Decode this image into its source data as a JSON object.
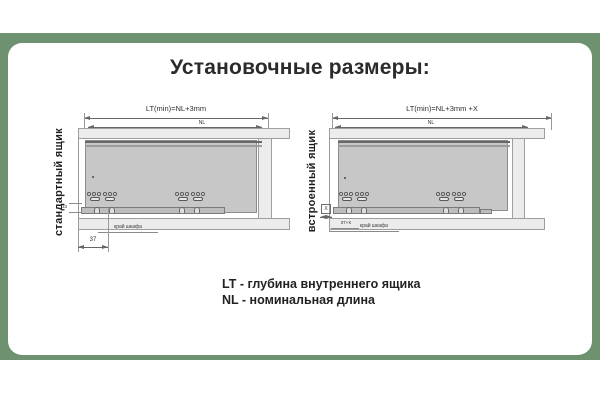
{
  "header": {
    "title": "Установочные размеры:"
  },
  "diagram_left": {
    "side_label": "стандартный ящик",
    "dim_lt": "LT(min)=NL+3mm",
    "dim_nl": "NL",
    "dim_height_small": "33",
    "dim_front_offset": "37",
    "cabinet_edge": "край шкафа"
  },
  "diagram_right": {
    "side_label": "встроенный ящик",
    "dim_lt": "LT(min)=NL+3mm +X",
    "dim_nl": "NL",
    "dim_inset": "X",
    "dim_front_offset": "37+X",
    "cabinet_edge": "край шкафа"
  },
  "legend": {
    "line1": "LT -  глубина внутреннего ящика",
    "line2": "NL - номинальная длина"
  },
  "colors": {
    "band_green": "#6E9270",
    "card_white": "#FFFFFF",
    "dimension_line": "#666666",
    "drawer_fill": "#C7C7C7",
    "cabinet_fill": "#ECECEC"
  }
}
